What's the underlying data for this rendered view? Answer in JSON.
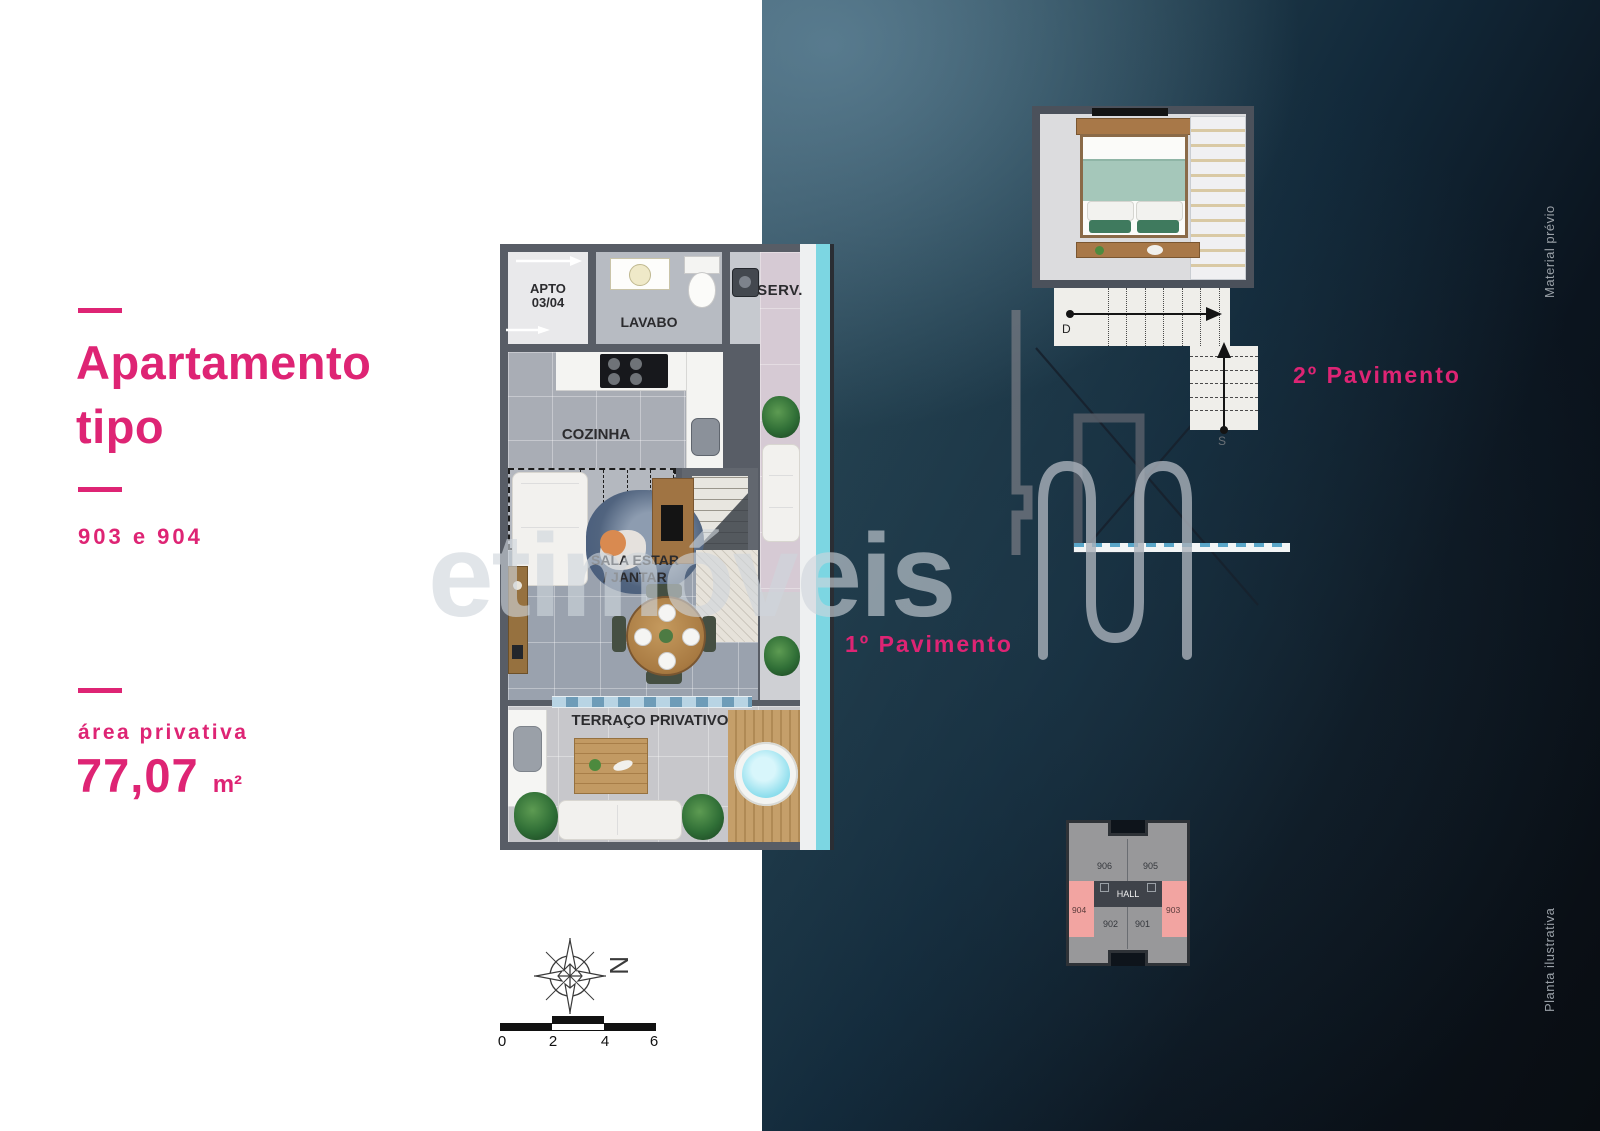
{
  "page": {
    "accent": "#de2474"
  },
  "left_panel": {
    "title_line1": "Apartamento",
    "title_line2": "tipo",
    "units": "903 e 904",
    "area_label": "área privativa",
    "area_value": "77,07",
    "area_unit": "m²"
  },
  "floor1": {
    "caption": "1º Pavimento",
    "apto_line1": "APTO",
    "apto_line2": "03/04",
    "lavabo": "LAVABO",
    "serv": "SERV.",
    "cozinha": "COZINHA",
    "projecao_line1": "PROJEÇÃO",
    "projecao_line2": "ESCADA",
    "sala_line1": "SALA ESTAR",
    "sala_line2": "/ JANTAR",
    "terraco": "TERRAÇO PRIVATIVO"
  },
  "floor2": {
    "caption": "2º Pavimento",
    "suite": "SUITE",
    "stair_down": "D",
    "stair_up": "S"
  },
  "keyplan": {
    "hall": "HALL",
    "unit_906": "906",
    "unit_905": "905",
    "unit_904": "904",
    "unit_903": "903",
    "unit_902": "902",
    "unit_901": "901",
    "highlight_color": "#f2a4a1"
  },
  "watermark": {
    "text": "etimóveis"
  },
  "compass": {
    "north": "N"
  },
  "scalebar": {
    "t0": "0",
    "t1": "2",
    "t2": "4",
    "t3": "6"
  },
  "side_notes": {
    "top": "Material prévio",
    "bottom": "Planta ilustrativa"
  }
}
